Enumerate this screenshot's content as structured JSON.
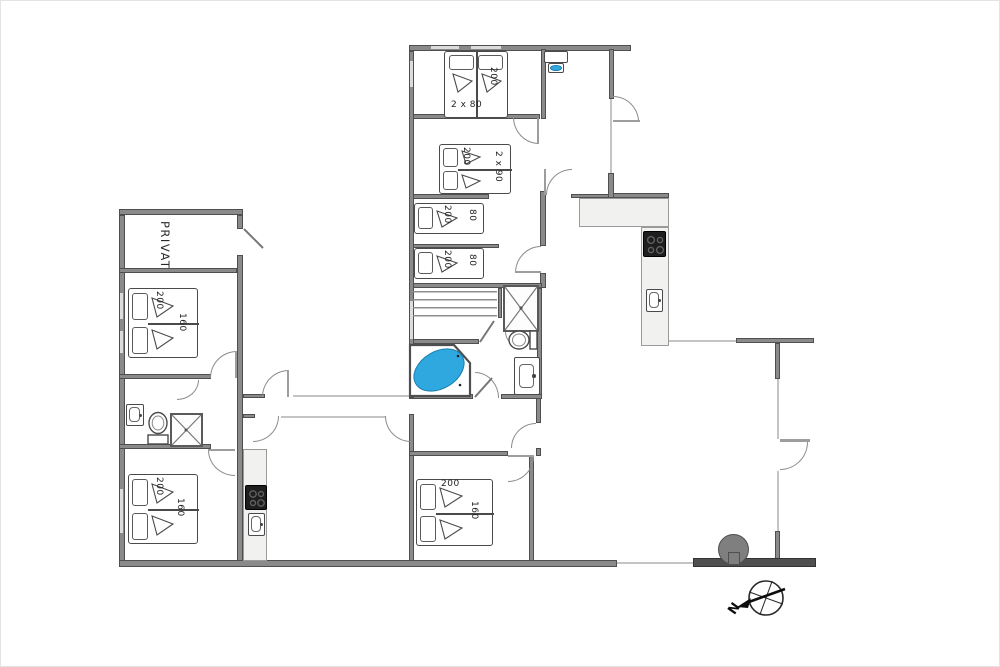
{
  "labels": {
    "private_room": "PRIVAT"
  },
  "beds": {
    "top_double": {
      "length": "200",
      "width": "2 x 80"
    },
    "second_double": {
      "length": "200",
      "width": "2 x 90"
    },
    "single_upper": {
      "length": "200",
      "width": "80"
    },
    "single_lower": {
      "length": "200",
      "width": "80"
    },
    "left_double_upper": {
      "length": "200",
      "width": "160"
    },
    "left_double_lower": {
      "length": "200",
      "width": "160"
    },
    "bottom_double": {
      "length": "200",
      "width": "160"
    }
  },
  "compass": {
    "north_label": "N"
  },
  "colors": {
    "bathtub_blue": "#2FA8DF",
    "wall_gray": "#8a8a8a",
    "dark_wall": "#4f4f4f",
    "cooktop_black": "#1e1e1e",
    "counter_light": "#f1f1f0",
    "tree_gray": "#7f7f7f"
  }
}
